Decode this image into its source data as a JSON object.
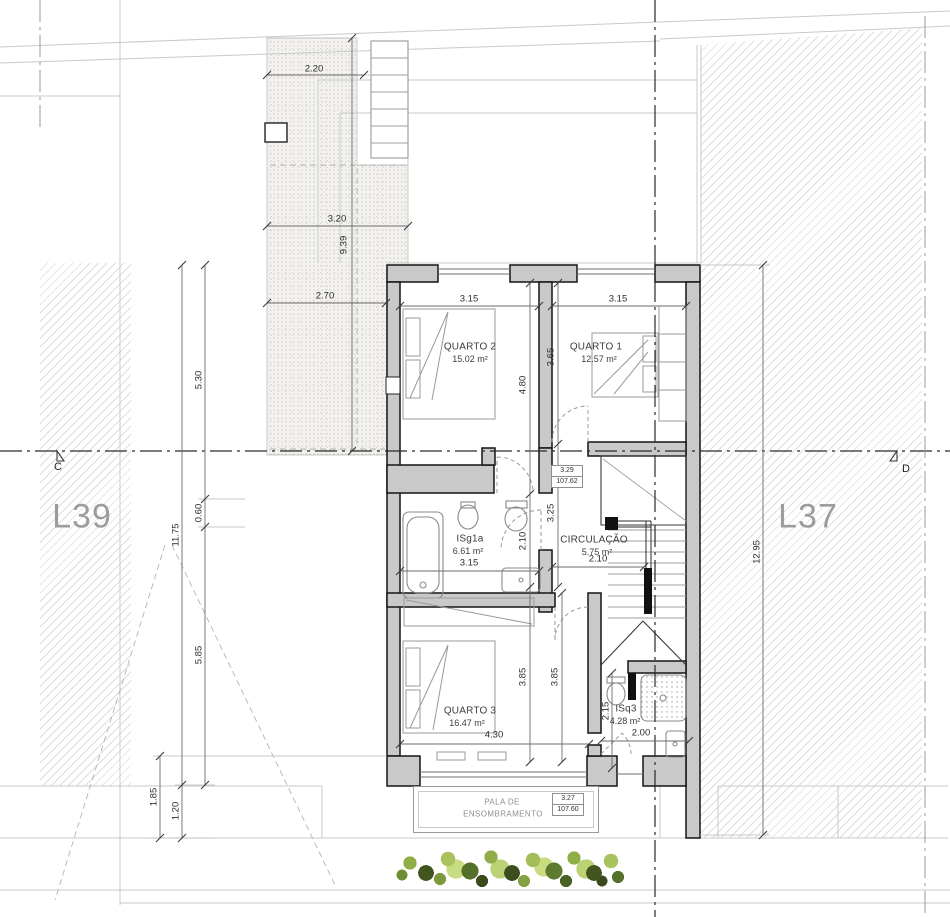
{
  "plan": {
    "lots": {
      "left": "L39",
      "right": "L37"
    },
    "sections": {
      "left": "C",
      "right": "D"
    },
    "rooms": {
      "quarto2": {
        "name": "QUARTO 2",
        "area": "15.02 m²"
      },
      "quarto1": {
        "name": "QUARTO 1",
        "area": "12.57 m²"
      },
      "isg1a": {
        "name": "ISg1a",
        "area": "6.61 m²"
      },
      "circulacao": {
        "name": "CIRCULAÇÃO",
        "area": "5.75 m²"
      },
      "quarto3": {
        "name": "QUARTO 3",
        "area": "16.47 m²"
      },
      "isq3": {
        "name": "ISq3",
        "area": "4.28 m²"
      },
      "pala": {
        "line1": "PALA DE",
        "line2": "ENSOMBRAMENTO"
      }
    },
    "levels": {
      "upper": {
        "height": "3.29",
        "elevation": "107.62"
      },
      "lower": {
        "height": "3.27",
        "elevation": "107.60"
      }
    },
    "dims": {
      "t220": "2.20",
      "t320": "3.20",
      "t939": "9.39",
      "t270": "2.70",
      "q2w": "3.15",
      "q1w": "3.15",
      "q2h": "4.80",
      "q1h": "3.65",
      "hall": "3.25",
      "isgw": "3.15",
      "isgh": "2.10",
      "circw": "2.10",
      "q3h1": "3.85",
      "q3h2": "3.85",
      "q3w": "4.30",
      "isq3h": "2.15",
      "isq3w": "2.00",
      "l530": "5.30",
      "l1175": "11.75",
      "l060": "0.60",
      "l585": "5.85",
      "l185": "1.85",
      "l120": "1.20",
      "r1295": "12.95"
    },
    "colors": {
      "wall_fill": "#c9c9c9",
      "outline": "#141414",
      "hatch_line": "#dedede",
      "stipple_bg": "#f3f2ef",
      "lot_text": "#9c9c9c",
      "veg_light": "#c9dc82",
      "veg_mid": "#8fae45",
      "veg_dark": "#42541f"
    }
  }
}
